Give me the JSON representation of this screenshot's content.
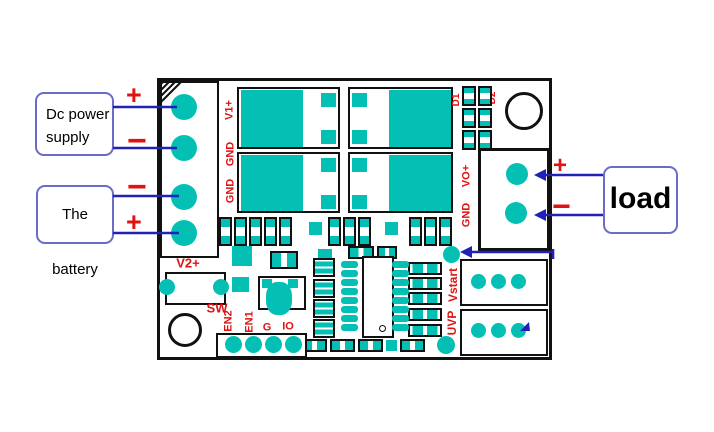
{
  "colors": {
    "pad_teal": "#04c0b4",
    "silkscreen_red": "#e01212",
    "wire_blue": "#2121b8",
    "annotation_border": "#6b6bc8"
  },
  "annotations": {
    "dc_power_supply": "Dc power supply",
    "battery": "The battery",
    "load": "load",
    "plus": "+",
    "minus": "−"
  },
  "silkscreen": {
    "v1_plus": "V1+",
    "gnd_in_1": "GND",
    "gnd_in_2": "GND",
    "v2_plus": "V2+",
    "sw": "SW",
    "en2": "EN2",
    "en1": "EN1",
    "g": "G",
    "io": "IO",
    "vstart": "Vstart",
    "uvp": "UVP",
    "vo_plus": "VO+",
    "gnd_out": "GND",
    "d1": "D1",
    "d2": "D2"
  }
}
